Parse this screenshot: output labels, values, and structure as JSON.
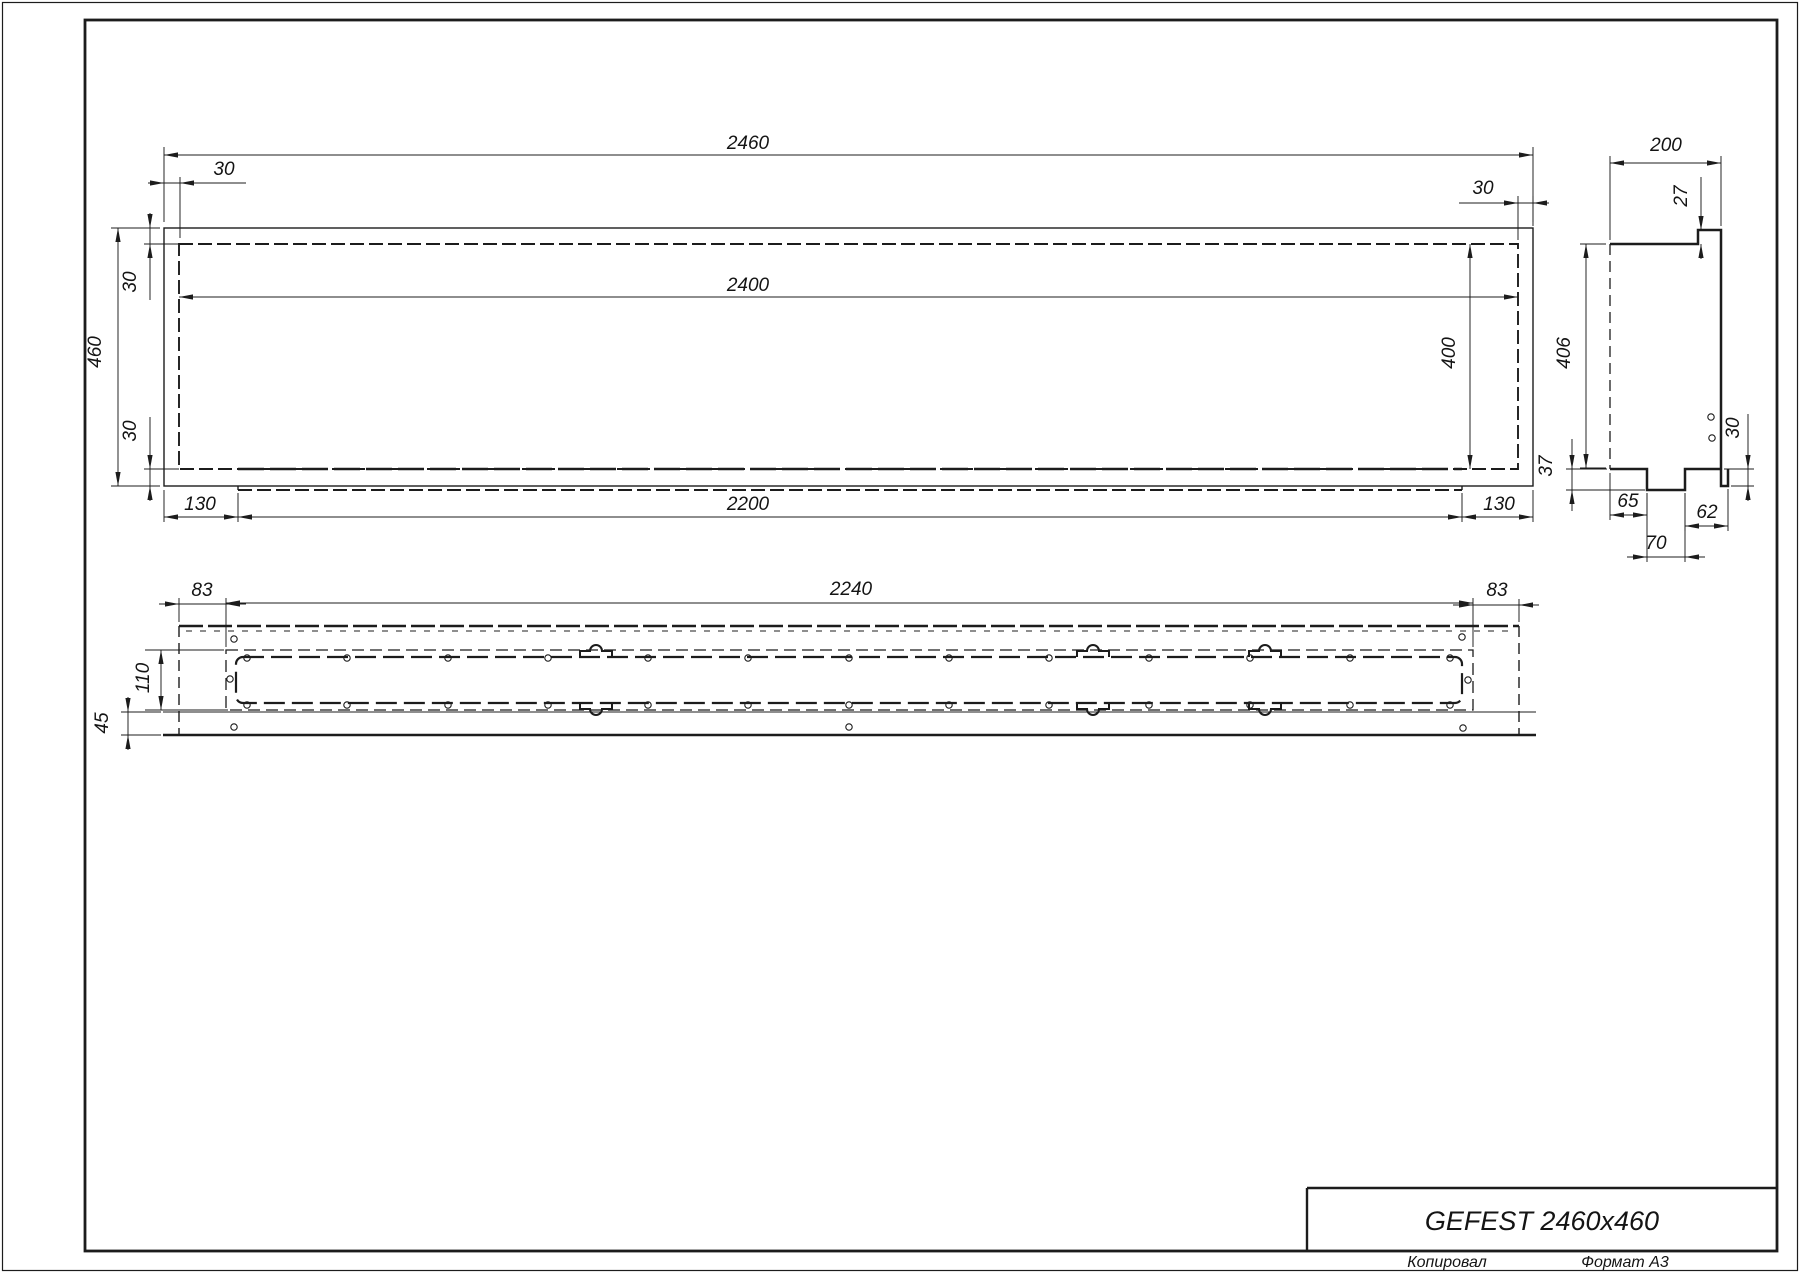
{
  "title_block": {
    "title": "GEFEST 2460x460",
    "copied_label": "Копировал",
    "format_label": "Формат А3"
  },
  "views": {
    "front": {
      "dims": {
        "width_total": "2460",
        "frame_left": "30",
        "frame_right": "30",
        "width_inner": "2400",
        "height_total": "460",
        "frame_top": "30",
        "frame_bottom": "30",
        "height_inner": "400",
        "tray_offset_left": "130",
        "tray_width": "2200",
        "tray_offset_right": "130"
      }
    },
    "side": {
      "dims": {
        "depth": "200",
        "top_lip": "27",
        "height_inner": "406",
        "bottom_lip": "30",
        "notch_depth": "37",
        "notch_offset_left": "65",
        "notch_offset_right": "62",
        "notch_width": "70"
      }
    },
    "top": {
      "dims": {
        "margin_left": "83",
        "slot_width": "2240",
        "margin_right": "83",
        "slot_depth": "110",
        "front_strip": "45"
      }
    }
  }
}
